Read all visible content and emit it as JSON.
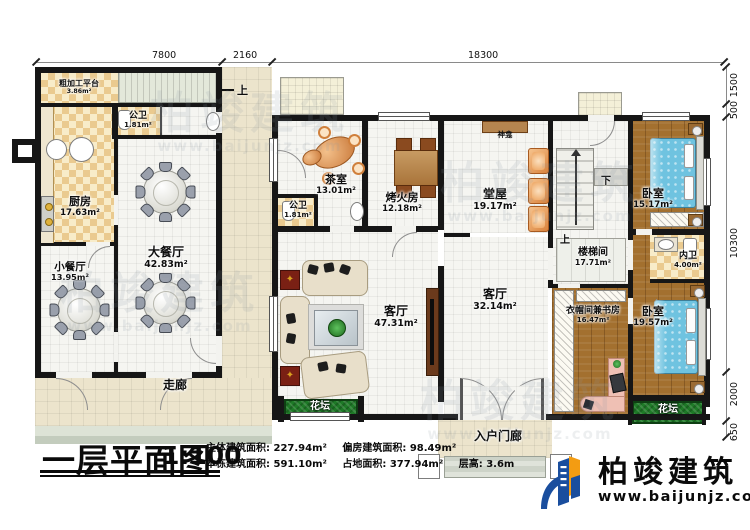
{
  "dims": {
    "top": [
      "7800",
      "2160",
      "18300"
    ],
    "right": [
      "1500",
      "500",
      "10300",
      "2000",
      "650"
    ]
  },
  "rooms": {
    "prep_platform": {
      "name": "粗加工平台",
      "area": "3.86m²"
    },
    "wc_left": {
      "name": "公卫",
      "area": "1.81m²"
    },
    "kitchen": {
      "name": "厨房",
      "area": "17.63m²"
    },
    "small_dining": {
      "name": "小餐厅",
      "area": "13.95m²"
    },
    "large_dining": {
      "name": "大餐厅",
      "area": "42.83m²"
    },
    "corridor": {
      "name": "走廊"
    },
    "tea_room": {
      "name": "茶室",
      "area": "13.01m²"
    },
    "wc_main": {
      "name": "公卫",
      "area": "1.81m²"
    },
    "fire_room": {
      "name": "烤火房",
      "area": "12.18m²"
    },
    "hall": {
      "name": "堂屋",
      "area": "19.17m²"
    },
    "shrine": {
      "name": "神龛"
    },
    "stair_room": {
      "name": "楼梯间",
      "area": "17.71m²"
    },
    "bedroom_top": {
      "name": "卧室",
      "area": "15.17m²"
    },
    "ensuite": {
      "name": "内卫",
      "area": "4.00m²"
    },
    "closet_study": {
      "name": "衣帽间兼书房",
      "area": "16.47m²"
    },
    "bedroom_bottom": {
      "name": "卧室",
      "area": "19.57m²"
    },
    "living_main": {
      "name": "客厅",
      "area": "47.31m²"
    },
    "living_entry": {
      "name": "客厅",
      "area": "32.14m²"
    },
    "porch": {
      "name": "入户门廊"
    },
    "flowerbed_left": {
      "name": "花坛"
    },
    "flowerbed_right": {
      "name": "花坛"
    }
  },
  "stairs": {
    "up": "上",
    "down": "下",
    "entry_up": "上"
  },
  "titleblock": {
    "title": "一层平面图",
    "scale": "1:100",
    "stats": [
      {
        "label": "主体建筑面积:",
        "value": "227.94m²"
      },
      {
        "label": "偏房建筑面积:",
        "value": "98.49m²"
      },
      {
        "label": "本栋建筑面积:",
        "value": "591.10m²"
      },
      {
        "label": "占地面积:",
        "value": "377.94m²"
      },
      {
        "label": "层高:",
        "value": "3.6m"
      }
    ]
  },
  "brand": {
    "name": "柏竣建筑",
    "site": "www.baijunjz.com",
    "blue": "#1a4e9e",
    "orange": "#f39c12"
  },
  "watermark": {
    "text": "柏竣建筑",
    "site": "www.baijunjz.com"
  }
}
